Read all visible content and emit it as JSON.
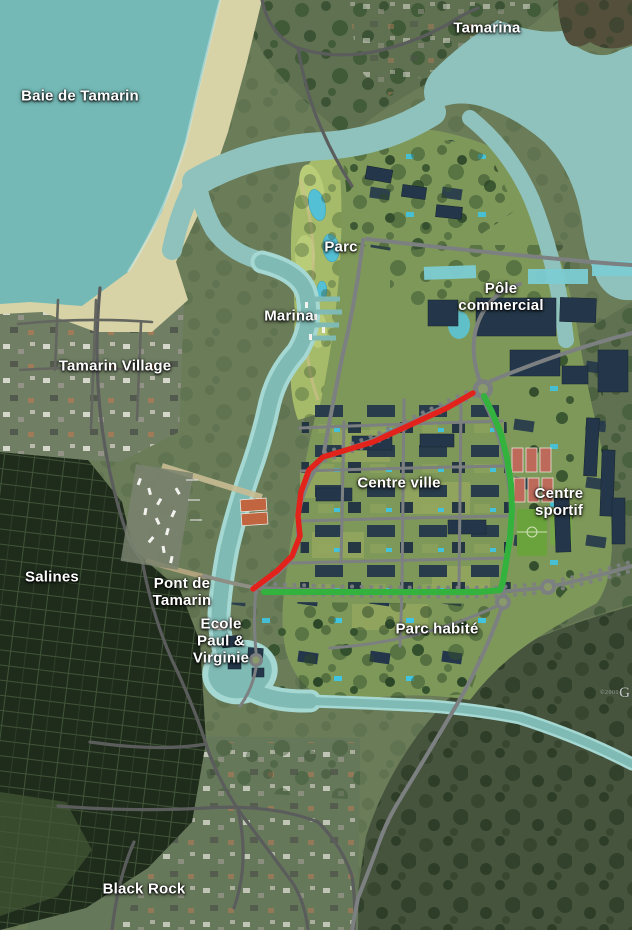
{
  "title": "Tamarin masterplan aerial map",
  "labels": {
    "tamarina": {
      "text": "Tamarina"
    },
    "baie_de_tamarin": {
      "text": "Baie de Tamarin"
    },
    "parc": {
      "text": "Parc"
    },
    "marina": {
      "text": "Marina"
    },
    "pole_commercial": {
      "lines": [
        "Pôle",
        "commercial"
      ]
    },
    "tamarin_village": {
      "text": "Tamarin Village"
    },
    "centre_ville": {
      "text": "Centre ville"
    },
    "centre_sportif": {
      "lines": [
        "Centre",
        "sportif"
      ]
    },
    "salines": {
      "text": "Salines"
    },
    "pont_de_tamarin": {
      "lines": [
        "Pont de",
        "Tamarin"
      ]
    },
    "ecole": {
      "lines": [
        "Ecole",
        "Paul &",
        "Virginie"
      ]
    },
    "parc_habite": {
      "text": "Parc habité"
    },
    "black_rock": {
      "text": "Black Rock"
    }
  },
  "routes": {
    "red": {
      "name": "red route line",
      "color": "#e2231c",
      "points": "473,393 447,408 373,442 323,457 309,470 301,492 298,516 300,536 292,556 277,571 253,589"
    },
    "green": {
      "name": "green route line",
      "color": "#33b33e",
      "points": "484,396 492,412 501,434 507,458 511,484 512,510 510,537 506,563 503,582 500,590 480,592 420,592 350,592 264,592"
    }
  },
  "palette": {
    "land": "#6b7c59",
    "sea": "#74b9b6",
    "estuary": "#8fc2bd",
    "river": "#7fbab4",
    "sand": "#d8d3a6",
    "plan_lawn": "#7e9859",
    "parc_green": "#a6bb69",
    "building": "#24374a",
    "tennis_clay": "#bd6a5b",
    "sport_field": "#6aa23c",
    "pool": "#41c4e0",
    "forest": "#46543e",
    "salines_dark": "#1f2c1c"
  },
  "watermark": {
    "prefix": "©2009",
    "text": "G"
  }
}
